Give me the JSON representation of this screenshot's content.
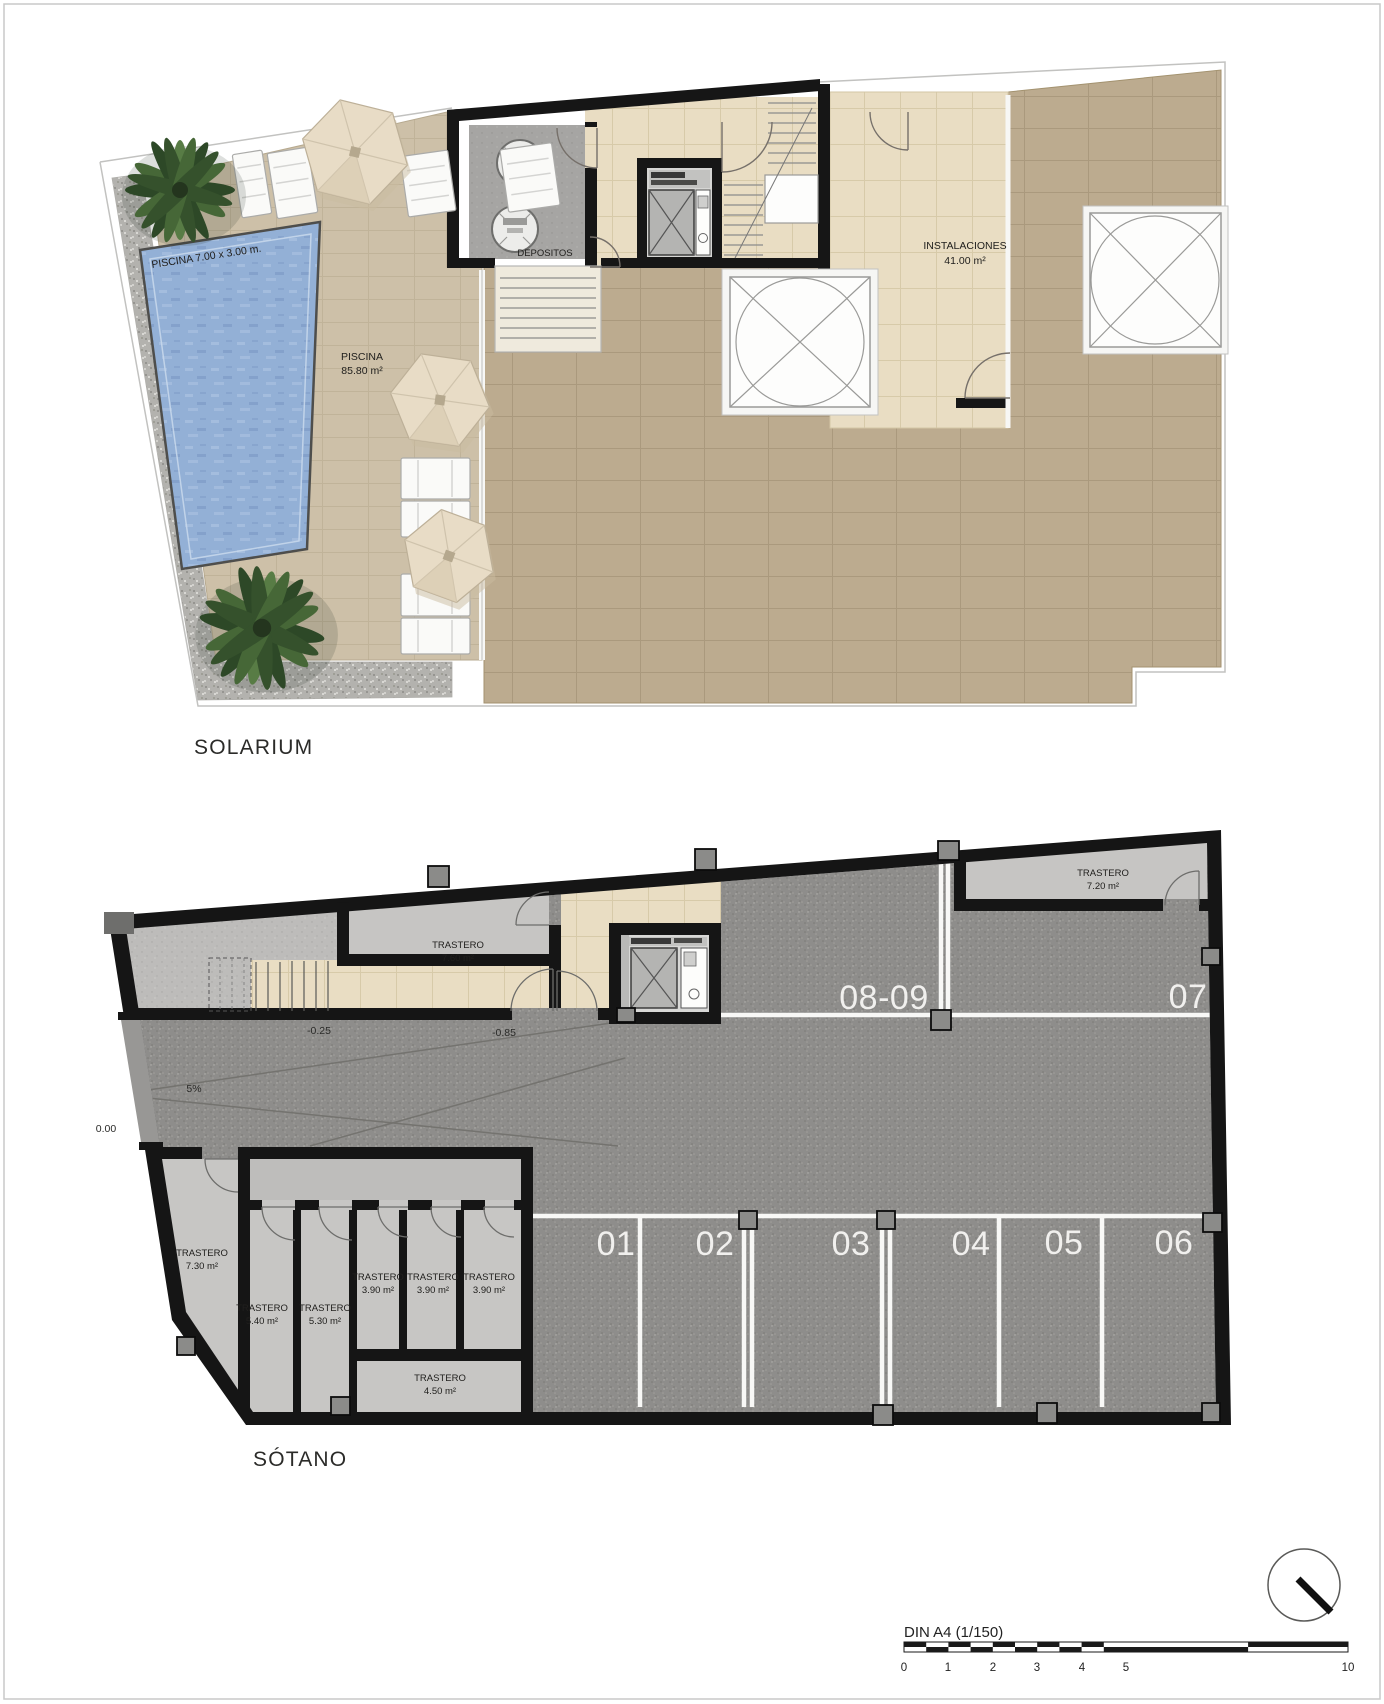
{
  "solarium": {
    "title": "SOLARIUM",
    "pool": {
      "dims_label": "PISCINA 7.00 x 3.00 m.",
      "name": "PISCINA",
      "area": "85.80 m²"
    },
    "depositos_label": "DEPOSITOS",
    "instalaciones": {
      "name": "INSTALACIONES",
      "area": "41.00 m²"
    }
  },
  "sotano": {
    "title": "SÓTANO",
    "levels": {
      "zero": "0.00",
      "minus_025": "-0.25",
      "minus_085": "-0.85",
      "slope": "5%"
    },
    "storage_rooms": [
      {
        "name": "TRASTERO",
        "area": "7.60 m²"
      },
      {
        "name": "TRASTERO",
        "area": "7.20 m²"
      },
      {
        "name": "TRASTERO",
        "area": "7.30 m²"
      },
      {
        "name": "TRASTERO",
        "area": "5.40 m²"
      },
      {
        "name": "TRASTERO",
        "area": "5.30 m²"
      },
      {
        "name": "TRASTERO",
        "area": "3.90 m²"
      },
      {
        "name": "TRASTERO",
        "area": "3.90 m²"
      },
      {
        "name": "TRASTERO",
        "area": "3.90 m²"
      },
      {
        "name": "TRASTERO",
        "area": "4.50 m²"
      }
    ],
    "parking_spaces": {
      "p01": "01",
      "p02": "02",
      "p03": "03",
      "p04": "04",
      "p05": "05",
      "p06": "06",
      "p07": "07",
      "p0809": "08-09"
    }
  },
  "footer": {
    "scale_label": "DIN A4 (1/150)",
    "ticks": [
      "0",
      "1",
      "2",
      "3",
      "4",
      "5",
      "10"
    ]
  }
}
